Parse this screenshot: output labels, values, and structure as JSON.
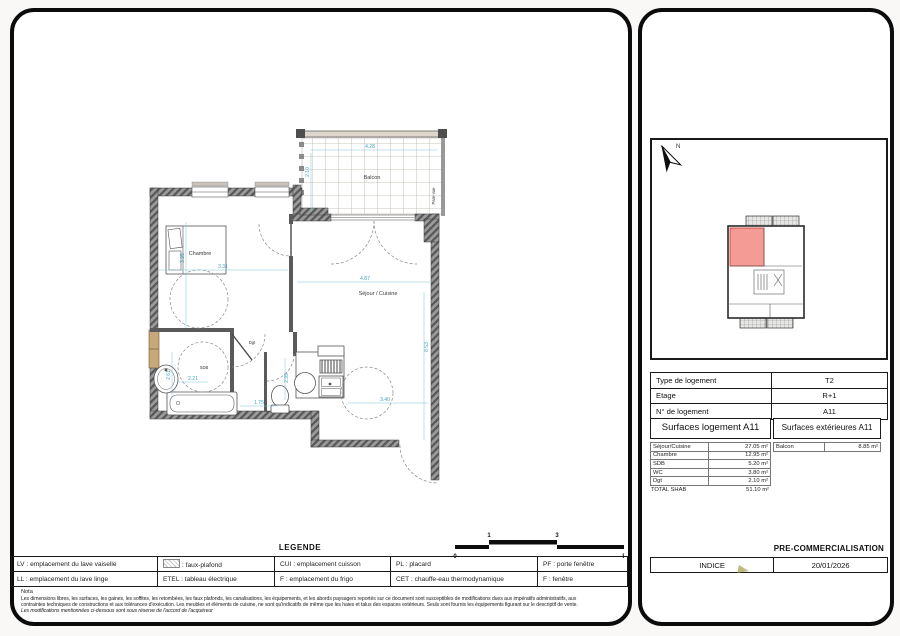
{
  "plan": {
    "labels": {
      "chambre": "Chambre",
      "sejour": "Séjour / Cuisine",
      "sdb": "SDB",
      "dgt": "Dgt",
      "balcon": "Balcon",
      "pare_vue": "Pare-vue"
    },
    "dimensions": {
      "chambre_width": "3.31",
      "chambre_height": "3.95",
      "sejour_width": "4.87",
      "sejour_height": "8.53",
      "balcon_width": "4.28",
      "balcon_depth": "2.10",
      "sdb_height": "2.61",
      "sdb_width": "2.21",
      "wc_width": "1.75",
      "wc_height": "2.99",
      "kitchen_width": "3.40"
    }
  },
  "scale_bar": {
    "ticks": [
      "0",
      "1",
      "3",
      "5"
    ]
  },
  "legend": {
    "title": "LEGENDE",
    "row1": {
      "c1": "LV : emplacement du lave vaiselle",
      "c2": ": faux-plafond",
      "c3": "CUI : emplacement cuisson",
      "c4": "PL : placard",
      "c5": "PF : porte fenêtre"
    },
    "row2": {
      "c1": "LL : emplacement du lave linge",
      "c2": "ETEL : tableau électrique",
      "c3": "F : emplacement du frigo",
      "c4": "CET : chauffe-eau thermodynamique",
      "c5": "F : fenêtre"
    }
  },
  "notes": {
    "title": "Nota",
    "line1": "Les dimensions libres, les surfaces, les gaines, les soffites, les retombées, les faux plafonds, les canalisations, les équipements, et les abords paysagers reportés sur ce document sont susceptibles de modifications dues aux impératifs administratifs, aux",
    "line2": "contraintes techniques de constructions et aux tolérances d'exécution. Les meubles et éléments de cuisine, ne sont qu'indicatifs de même que les haies et talus des espaces extérieurs. Seuls sont fournis les équipements figurant sur le descriptif de vente.",
    "line3": "Les modifications mentionnées ci-dessous sont sous réserve de l'accord de l'acquéreur"
  },
  "key_panel": {
    "north_label": "N"
  },
  "info_table": {
    "rows": [
      {
        "label": "Type de logement",
        "value": "T2"
      },
      {
        "label": "Etage",
        "value": "R+1"
      },
      {
        "label": "N° de logement",
        "value": "A11"
      }
    ]
  },
  "surfaces": {
    "title": "Surfaces logement A11",
    "rows": [
      {
        "label": "Séjour/Cuisine",
        "value": "27.05 m²"
      },
      {
        "label": "Chambre",
        "value": "12.95 m²"
      },
      {
        "label": "SDB",
        "value": "5.20 m²"
      },
      {
        "label": "WC",
        "value": "3.80 m²"
      },
      {
        "label": "Dgt",
        "value": "2.10 m²"
      }
    ],
    "total_label": "TOTAL SHAB",
    "total_value": "51.10 m²"
  },
  "surfaces_ext": {
    "title": "Surfaces extérieures A11",
    "rows": [
      {
        "label": "Balcon",
        "value": "8.85 m²"
      }
    ]
  },
  "footer": {
    "status": "PRE-COMMERCIALISATION",
    "indice_label": "INDICE",
    "date": "20/01/2026"
  }
}
